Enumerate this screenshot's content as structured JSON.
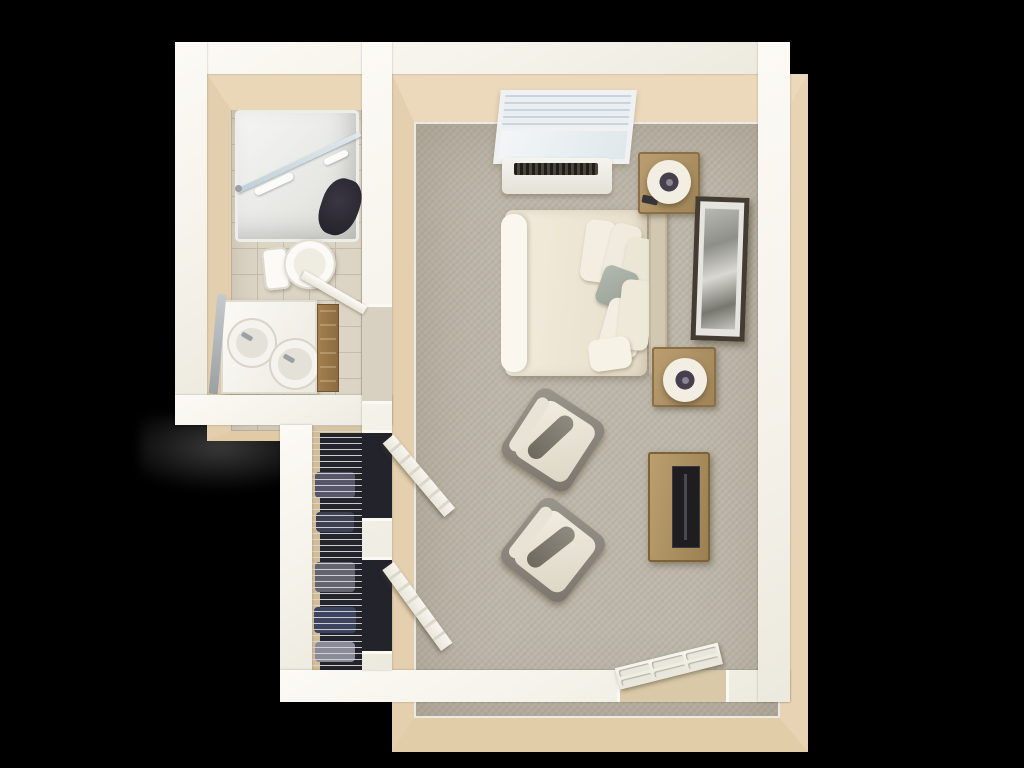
{
  "scene": {
    "description": "Top-down 3D rendered floor plan of a studio apartment with a bathroom, a walk-in closet and a combined bedroom/living area",
    "background_color": "#000000",
    "wall_color": "#f8f5ee",
    "wall_face_color": "#e7d4b4",
    "carpet_color": "#bdb7aa",
    "tile_color": "#dcd5c6",
    "wood_color": "#b1905f",
    "accent_pillow_color": "#a9b2a6",
    "tv_color": "#1e1d20"
  },
  "labels": {
    "plan": "Studio apartment 3D floor plan",
    "bathroom": "Bathroom",
    "closet": "Closet",
    "bedroom": "Bedroom living area",
    "shower": "Walk-in shower",
    "shower_glass": "Shower glass panel",
    "shower_seat": "Shower seat",
    "grab_bar": "Shower grab bar",
    "toilet": "Toilet",
    "vanity": "Vanity with two sinks",
    "sink": "Sink",
    "faucet": "Faucet",
    "mirror": "Vanity mirror",
    "cabinet": "Bathroom storage cabinet",
    "bathroom_door": "Bathroom door",
    "shelving": "Closet wire shelving",
    "clothes": "Stored clothes",
    "closet_door": "Closet door",
    "window": "Window with blinds",
    "ac_unit": "PTAC air conditioning unit",
    "bed": "Bed with duvet",
    "sheet": "Folded sheet",
    "headboard": "Headboard",
    "pillow": "Pillow",
    "accent_pillow": "Sage accent pillow",
    "nightstand": "Nightstand",
    "lamp": "Table lamp",
    "phone": "Phone on nightstand",
    "wall_art": "Framed wall art",
    "armchair": "Armchair",
    "tv_console": "Media console",
    "tv": "Flat screen TV",
    "entry_door": "Entry door",
    "doorway": "Doorway opening"
  }
}
